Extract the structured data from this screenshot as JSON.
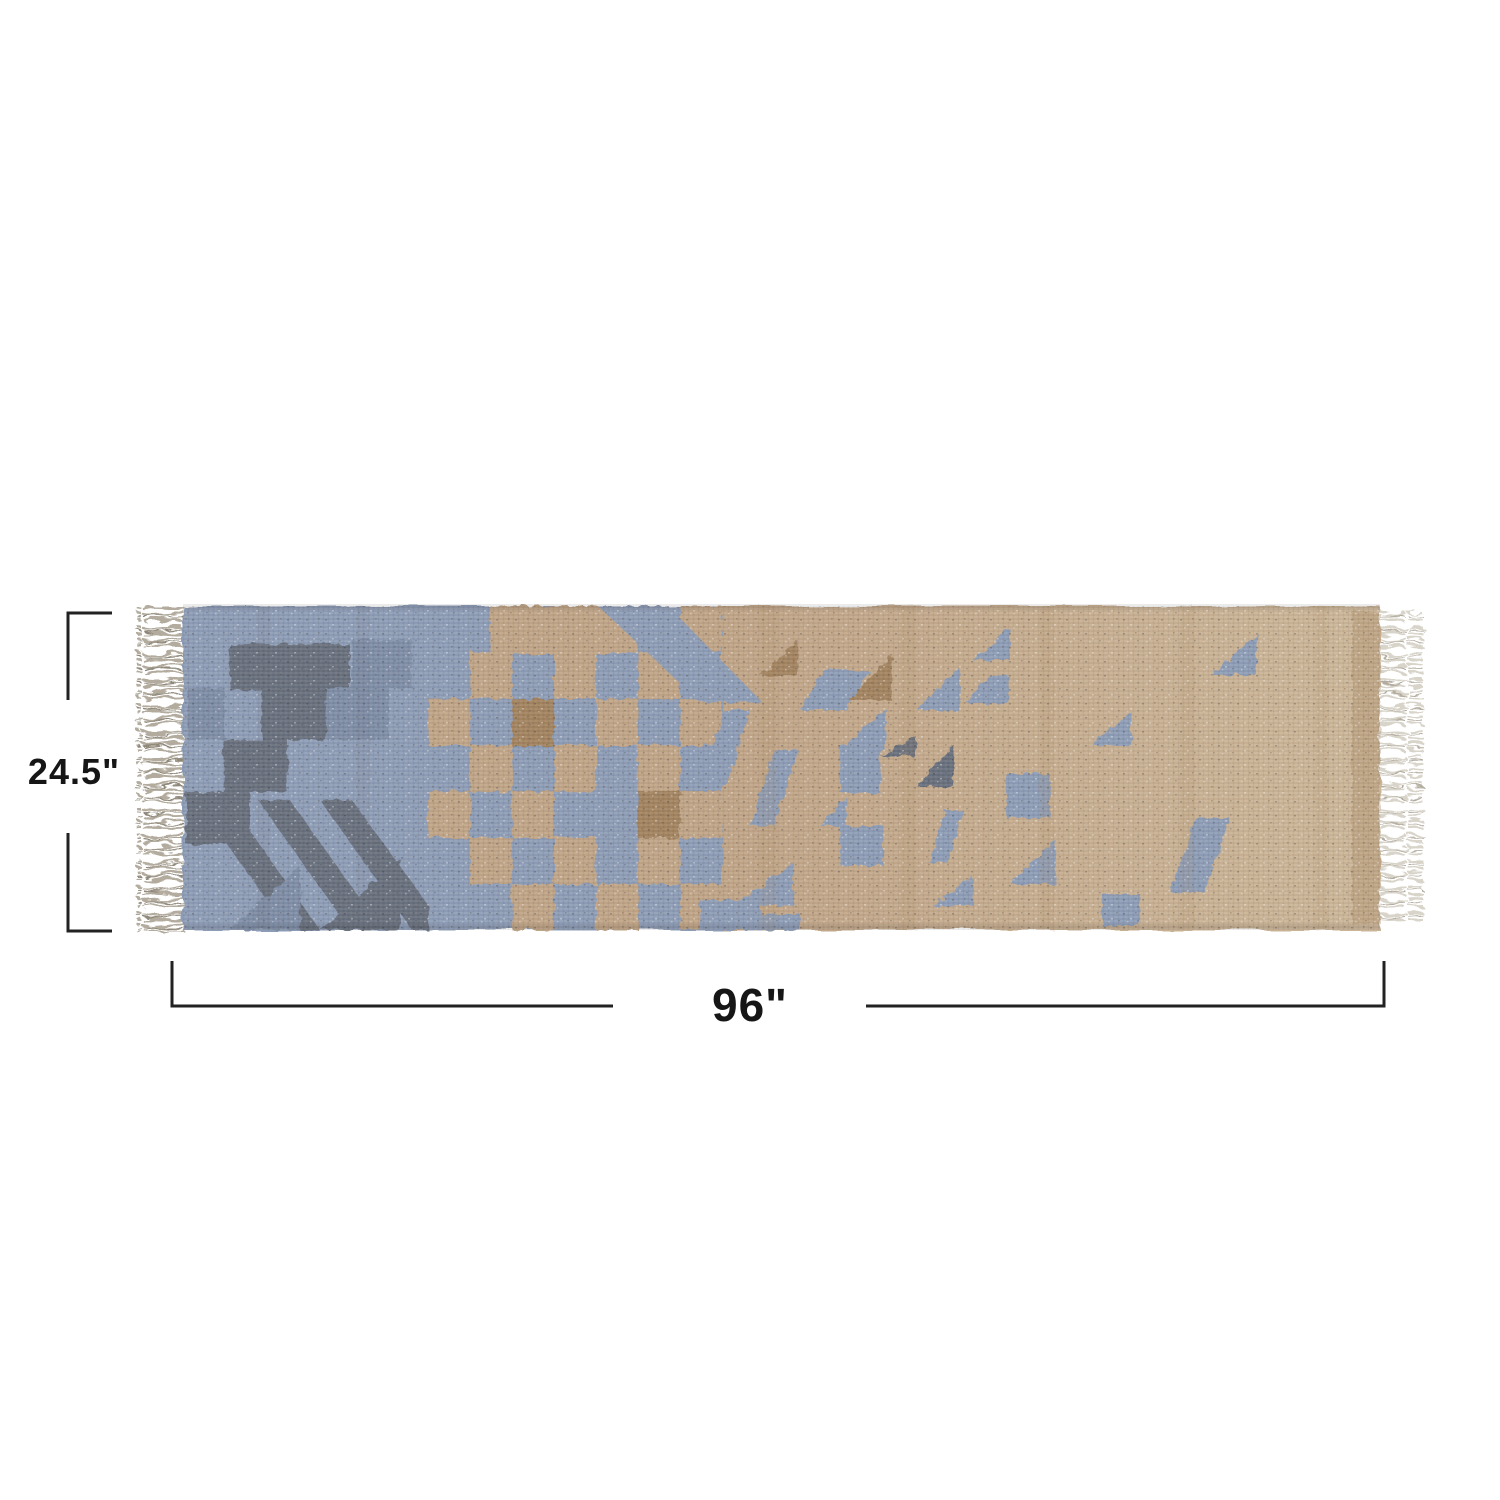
{
  "page": {
    "background_color": "#ffffff"
  },
  "rug": {
    "alt": "Flat-woven runner rug with geometric kilim pattern in blue and natural jute, fringed ends",
    "colors": {
      "blue": "#8d9cb6",
      "blue_mid": "#7e8da6",
      "blue_dark": "#68707d",
      "tan": "#c0a486",
      "tan_dark": "#a2835f",
      "tan_light": "#ccb698",
      "fringe": "#b2ab9e",
      "fringe_light": "#d8d4ca",
      "fringe_dark": "#8f887a"
    }
  },
  "dimensions": {
    "height": {
      "label": "24.5\""
    },
    "width": {
      "label": "96\""
    },
    "line_color": "#222222",
    "text_color": "#161616"
  }
}
